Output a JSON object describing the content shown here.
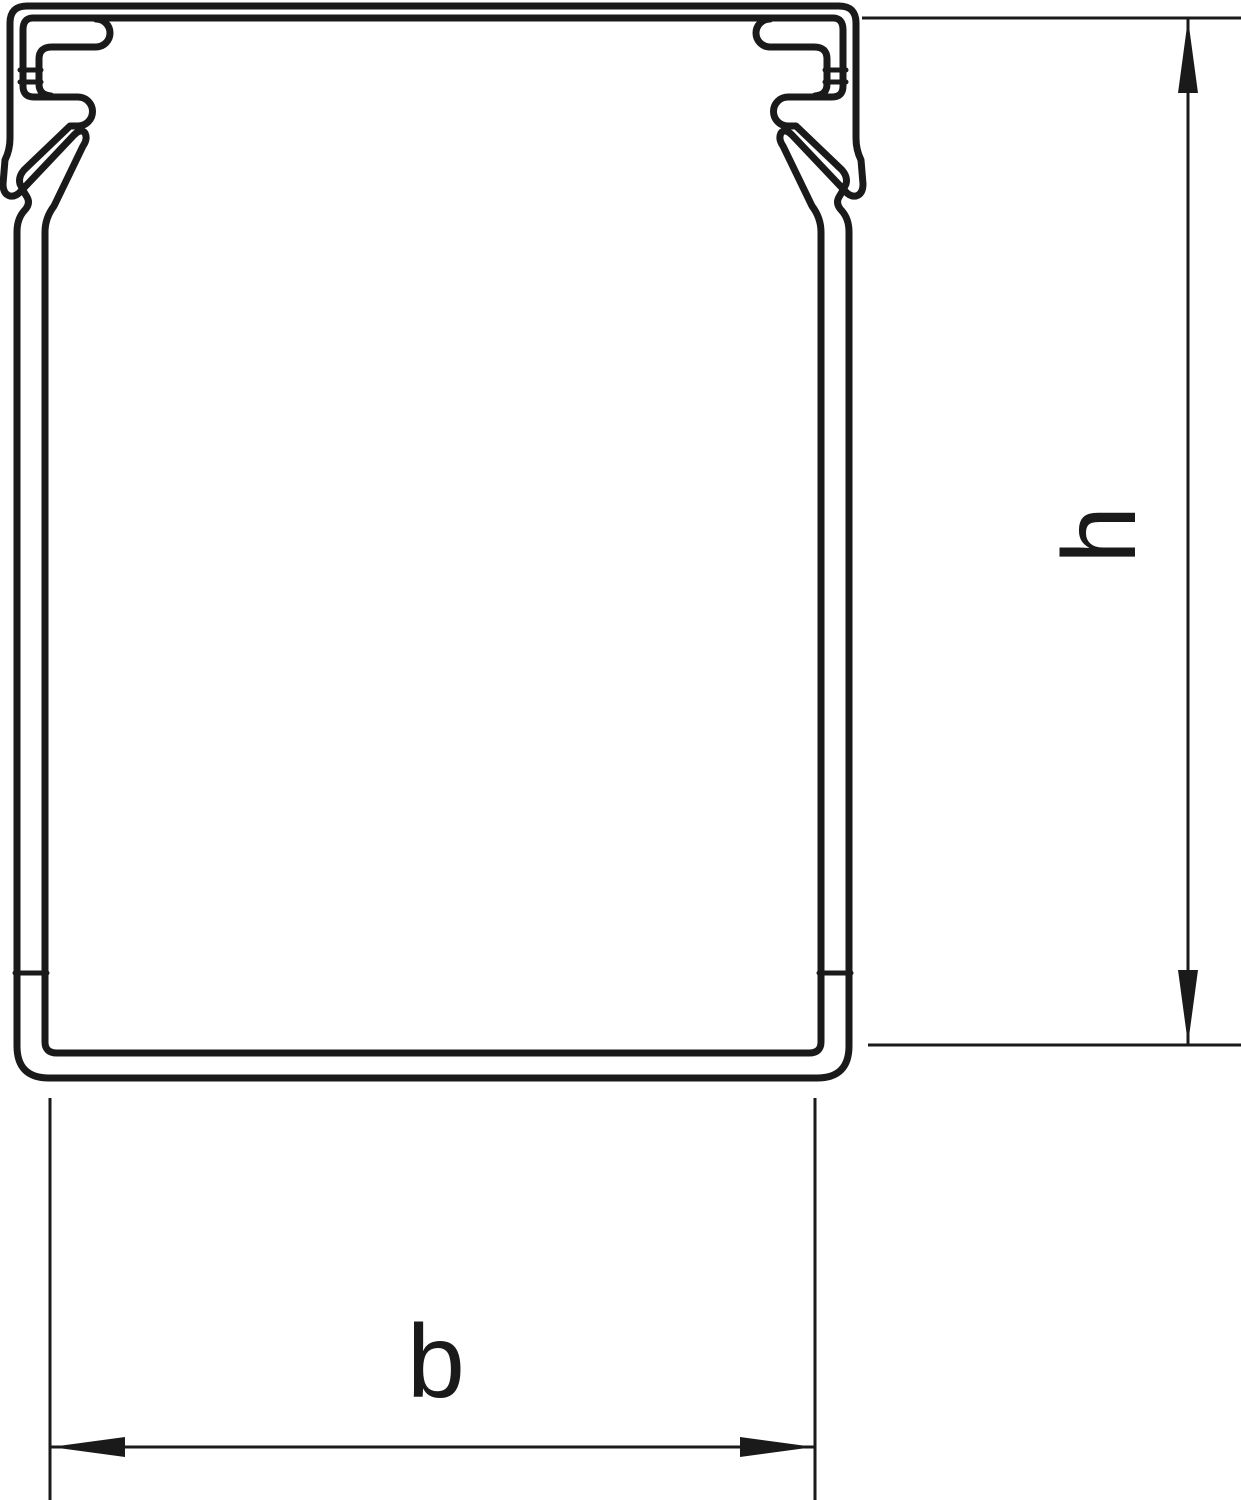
{
  "drawing": {
    "type": "technical-cross-section",
    "subject": "cable trunking / wiring duct profile",
    "background_color": "#ffffff",
    "line_color": "#1a1a1a",
    "dimensions": {
      "height": {
        "label": "h",
        "orientation": "vertical",
        "side": "right",
        "measures": "inner height of duct from top edge to inside of base"
      },
      "width": {
        "label": "b",
        "orientation": "horizontal",
        "side": "bottom",
        "measures": "inner width of duct between side walls"
      }
    }
  }
}
